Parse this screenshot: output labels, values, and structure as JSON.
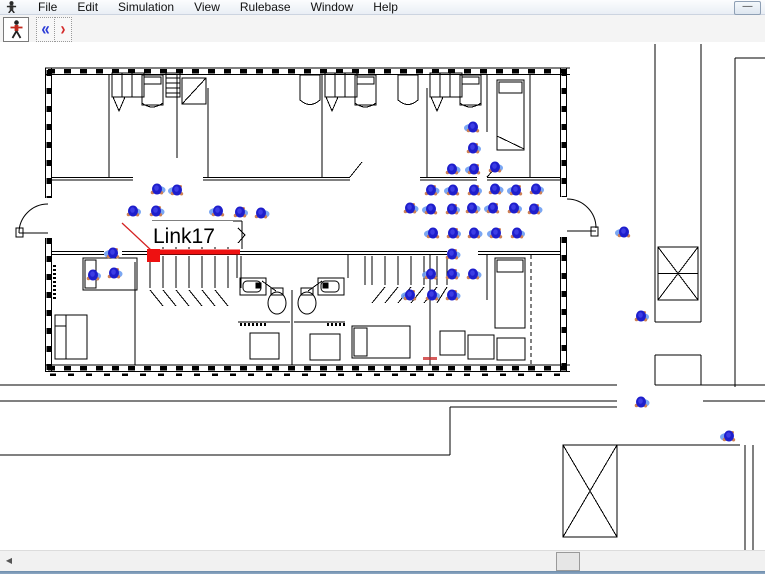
{
  "menu": {
    "items": [
      "File",
      "Edit",
      "Simulation",
      "View",
      "Rulebase",
      "Window",
      "Help"
    ]
  },
  "window_controls": {
    "minimize_glyph": "—"
  },
  "toolbar": {
    "buttons": [
      {
        "icon": "person-walking-icon"
      },
      {
        "icon": "double-chevron-left-icon",
        "glyph": "«",
        "color": "#2b3bd6"
      },
      {
        "icon": "chevron-right-icon",
        "glyph": "›",
        "color": "#d42a2a"
      }
    ]
  },
  "canvas": {
    "link_label": "Link17",
    "colors": {
      "agent_core": "#1e1ecb",
      "agent_halo": "#6d9df2",
      "agent_fringe": "#cd8055",
      "link_red": "#ee1111"
    },
    "agents": [
      [
        157,
        189
      ],
      [
        177,
        190
      ],
      [
        133,
        211
      ],
      [
        156,
        211
      ],
      [
        218,
        211
      ],
      [
        240,
        212
      ],
      [
        261,
        213
      ],
      [
        113,
        253
      ],
      [
        93,
        275
      ],
      [
        114,
        273
      ],
      [
        473,
        127
      ],
      [
        473,
        148
      ],
      [
        452,
        169
      ],
      [
        474,
        169
      ],
      [
        495,
        167
      ],
      [
        431,
        190
      ],
      [
        453,
        190
      ],
      [
        474,
        190
      ],
      [
        495,
        189
      ],
      [
        516,
        190
      ],
      [
        536,
        189
      ],
      [
        410,
        208
      ],
      [
        431,
        209
      ],
      [
        452,
        209
      ],
      [
        472,
        208
      ],
      [
        493,
        208
      ],
      [
        514,
        208
      ],
      [
        534,
        209
      ],
      [
        433,
        233
      ],
      [
        453,
        233
      ],
      [
        474,
        233
      ],
      [
        496,
        233
      ],
      [
        517,
        233
      ],
      [
        452,
        254
      ],
      [
        431,
        274
      ],
      [
        452,
        274
      ],
      [
        473,
        274
      ],
      [
        410,
        295
      ],
      [
        432,
        295
      ],
      [
        452,
        295
      ],
      [
        624,
        232
      ],
      [
        641,
        316
      ],
      [
        641,
        402
      ],
      [
        729,
        436
      ]
    ]
  },
  "scrollbar": {
    "left_arrow_glyph": "◀"
  }
}
